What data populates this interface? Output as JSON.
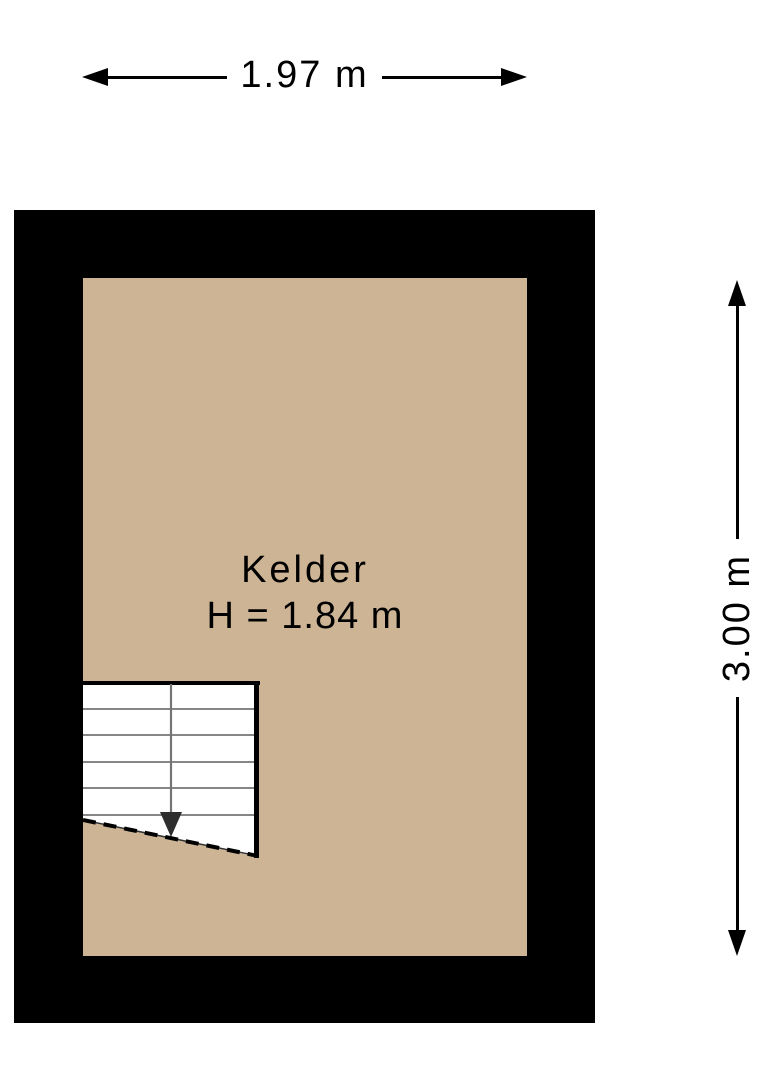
{
  "colors": {
    "background": "#ffffff",
    "wall": "#000000",
    "floor": "#ccb495",
    "dimension": "#000000",
    "text": "#000000",
    "stair_line": "#757575",
    "stair_arrow": "#2e2e2e"
  },
  "dimensions": {
    "width": {
      "label": "1.97 m"
    },
    "height": {
      "label": "3.00 m"
    }
  },
  "room": {
    "name": "Kelder",
    "height_label": "H = 1.84 m"
  }
}
